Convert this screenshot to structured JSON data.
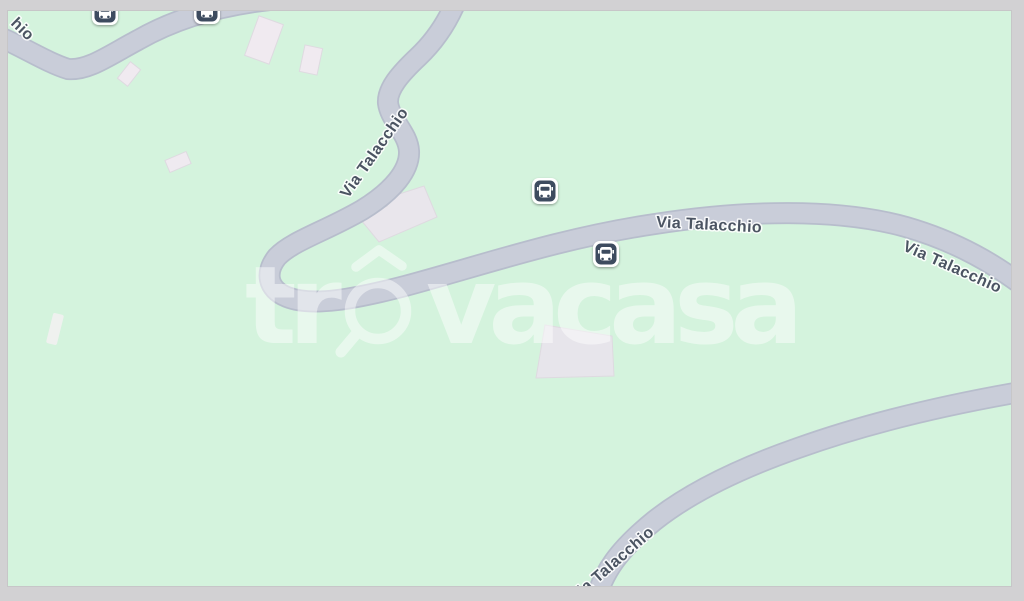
{
  "map": {
    "watermark": {
      "prefix": "tr",
      "suffix": "vacasa"
    },
    "road_labels": [
      {
        "id": "road-label-left-partial",
        "text": "hio"
      },
      {
        "id": "road-label-s-curve",
        "text": "Via Talacchio"
      },
      {
        "id": "road-label-middle",
        "text": "Via Talacchio"
      },
      {
        "id": "road-label-right",
        "text": "Via Talacchio"
      },
      {
        "id": "road-label-bottom",
        "text": "Via Talacchio"
      }
    ],
    "poi_icons": [
      {
        "name": "bus-stop-icon",
        "position": "top-left-1"
      },
      {
        "name": "bus-stop-icon",
        "position": "top-left-2"
      },
      {
        "name": "bus-stop-icon",
        "position": "center-upper"
      },
      {
        "name": "bus-stop-icon",
        "position": "center-lower"
      }
    ],
    "colors": {
      "terrain": "#d4f3dd",
      "road_fill": "#c9cdd9",
      "road_casing": "#b7bdcc",
      "building_fill": "#eee9ef",
      "building_stroke": "#dedae0",
      "label_text": "#4b5462",
      "bus_icon_bg": "#3d4b5e",
      "frame": "#d2d1d3",
      "watermark": "#ffffff"
    }
  }
}
